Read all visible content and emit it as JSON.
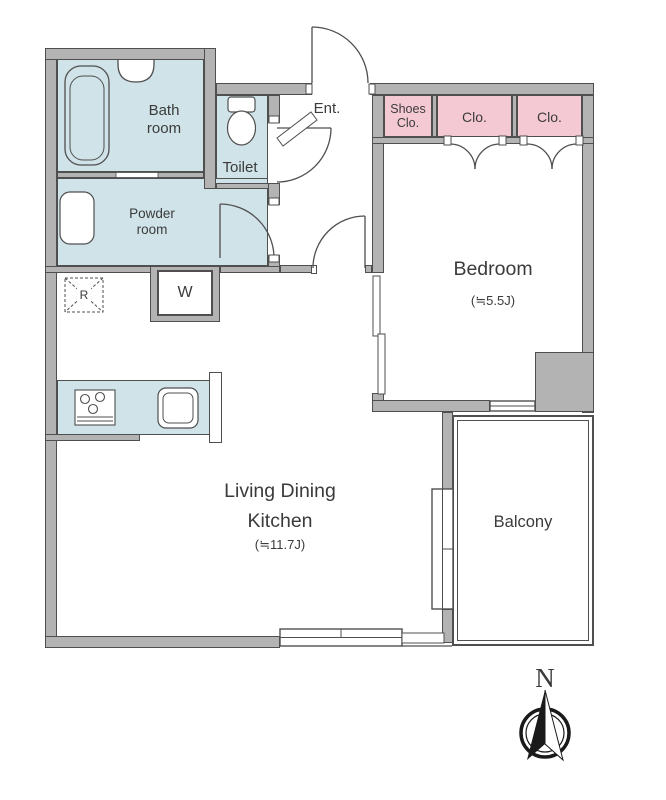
{
  "rooms": {
    "bathroom": {
      "label": "Bath room"
    },
    "toilet": {
      "label": "Toilet"
    },
    "powder_room": {
      "label": "Powder room"
    },
    "entrance": {
      "label": "Ent."
    },
    "shoes_closet": {
      "label": "Shoes Clo."
    },
    "closet_1": {
      "label": "Clo."
    },
    "closet_2": {
      "label": "Clo."
    },
    "bedroom": {
      "label": "Bedroom",
      "area": "(≒5.5J)"
    },
    "ldk": {
      "label": "Living Dining Kitchen",
      "area": "(≒11.7J)"
    },
    "balcony": {
      "label": "Balcony"
    }
  },
  "fixtures": {
    "washing_machine": {
      "label": "W"
    },
    "refrigerator": {
      "label": "R"
    }
  },
  "compass": {
    "label": "N"
  },
  "colors": {
    "wall": "#b3b3b3",
    "outline": "#4f4f4f",
    "wet_area": "#cfe3e8",
    "closet": "#f5c9d4",
    "text": "#3b3b3b"
  }
}
